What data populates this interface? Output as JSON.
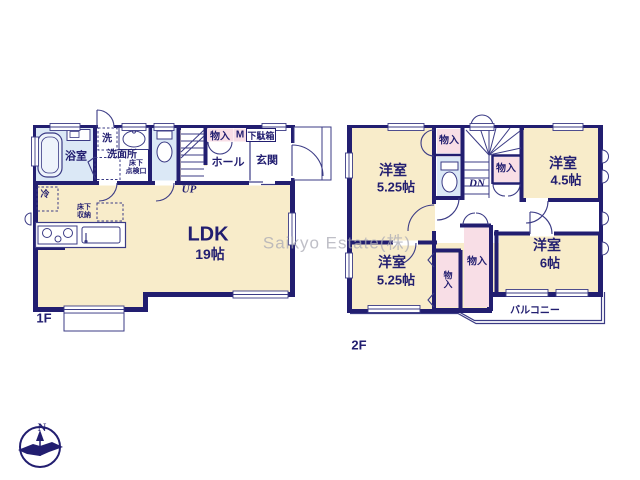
{
  "watermark": "Saikyo Estate(株)",
  "compass": {
    "north": "N"
  },
  "colors": {
    "wall": "#221e70",
    "floor": "#f8ecca",
    "wet_area": "#dbe8f6",
    "closet": "#f8dee6"
  },
  "floor1": {
    "floor_label": "1F",
    "bath": "浴室",
    "laundry": "洗",
    "washroom": "洗面所",
    "hatch_line1": "床下",
    "hatch_line2": "点検口",
    "closet": "物入",
    "meter": "M",
    "shoebox": "下駄箱",
    "hall": "ホール",
    "entrance": "玄関",
    "up": "UP",
    "fridge": "冷",
    "underfloor_line1": "床下",
    "underfloor_line2": "収納",
    "ldk_name": "LDK",
    "ldk_size": "19帖"
  },
  "floor2": {
    "floor_label": "2F",
    "room_tl_name": "洋室",
    "room_tl_size": "5.25帖",
    "room_tr_name": "洋室",
    "room_tr_size": "4.5帖",
    "room_bl_name": "洋室",
    "room_bl_size": "5.25帖",
    "room_br_name": "洋室",
    "room_br_size": "6帖",
    "closet_top": "物入",
    "closet_mid": "物入",
    "closet_vertical": "物入",
    "closet_center": "物入",
    "down": "DN",
    "balcony": "バルコニー"
  }
}
